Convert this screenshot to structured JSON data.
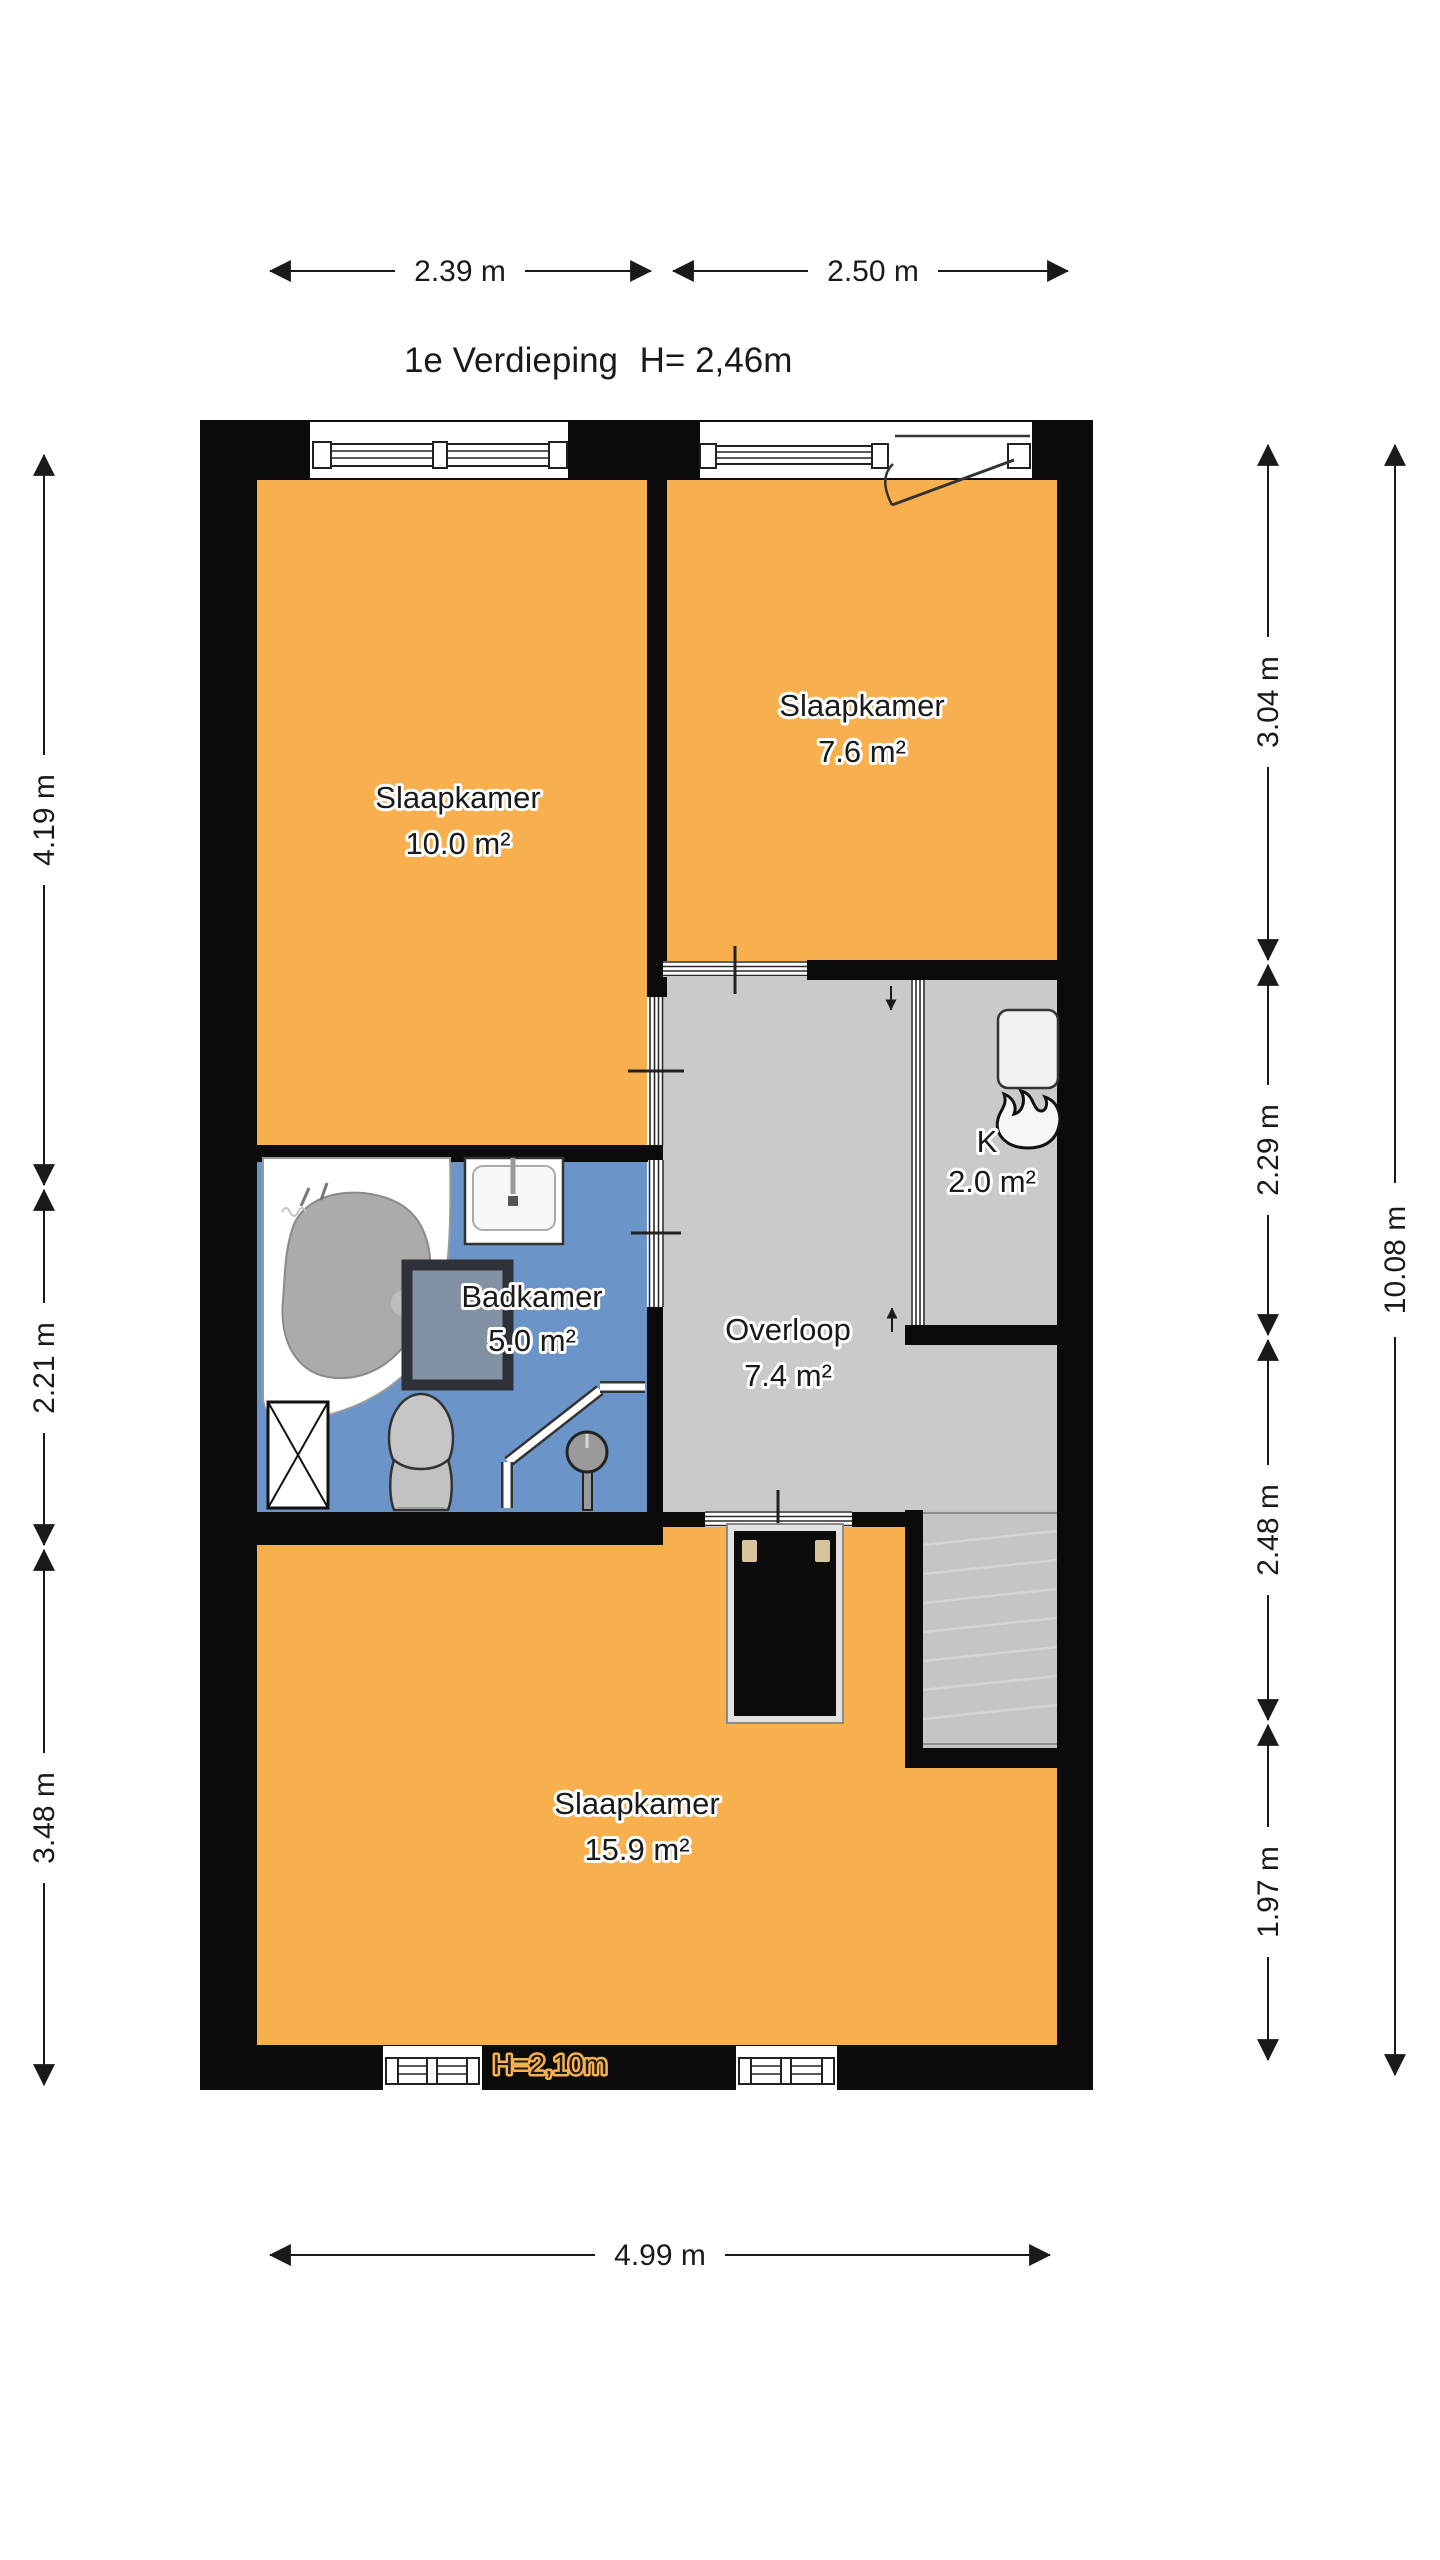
{
  "title": {
    "floor_label": "1e Verdieping",
    "ceiling_height": "H= 2,46m"
  },
  "rooms": {
    "bedroom_left": {
      "name": "Slaapkamer",
      "area": "10.0 m²"
    },
    "bedroom_right": {
      "name": "Slaapkamer",
      "area": "7.6 m²"
    },
    "bathroom": {
      "name": "Badkamer",
      "area": "5.0 m²"
    },
    "landing": {
      "name": "Overloop",
      "area": "7.4 m²"
    },
    "closet": {
      "name": "K",
      "area": "2.0 m²"
    },
    "bedroom_large": {
      "name": "Slaapkamer",
      "area": "15.9 m²",
      "height_note": "H=2,10m"
    }
  },
  "dimensions": {
    "top": [
      "2.39 m",
      "2.50 m"
    ],
    "bottom": "4.99 m",
    "left": [
      "4.19 m",
      "2.21 m",
      "3.48 m"
    ],
    "right": [
      "3.04 m",
      "2.29 m",
      "2.48 m",
      "1.97 m"
    ],
    "right_total": "10.08 m"
  },
  "colors": {
    "bedroom_fill": "#F8B04F",
    "bathroom_fill": "#6B95C9",
    "landing_fill": "#CACACA",
    "stairs_fill": "#C5C5C5",
    "wall": "#0B0B0B",
    "text": "#1A1A1A"
  }
}
